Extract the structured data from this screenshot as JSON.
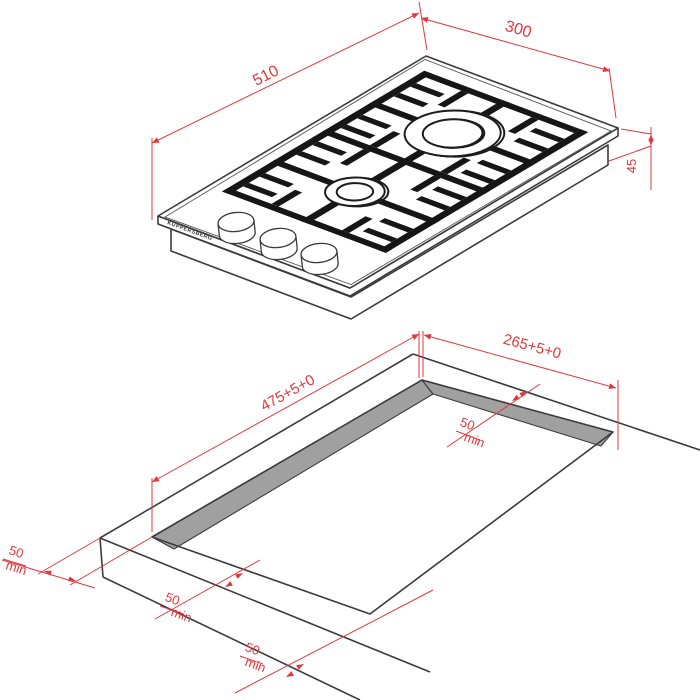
{
  "brand": "KUPPERSBERG",
  "top_view": {
    "length": "510",
    "width": "300",
    "height": "45"
  },
  "cutout_view": {
    "length": "475+5+0",
    "width": "265+5+0",
    "clearance_right": {
      "value": "50",
      "unit": "min"
    },
    "clearance_left": {
      "value": "50",
      "unit": "min"
    },
    "clearance_front": {
      "value": "50",
      "unit": "min"
    },
    "clearance_front_edge": {
      "value": "50",
      "unit": "min"
    }
  },
  "colors": {
    "dimension_red": "#e0383d",
    "line_dark": "#3b3b3b",
    "grate_black": "#161616",
    "cutout_wall_gray": "#a0a0a0"
  }
}
